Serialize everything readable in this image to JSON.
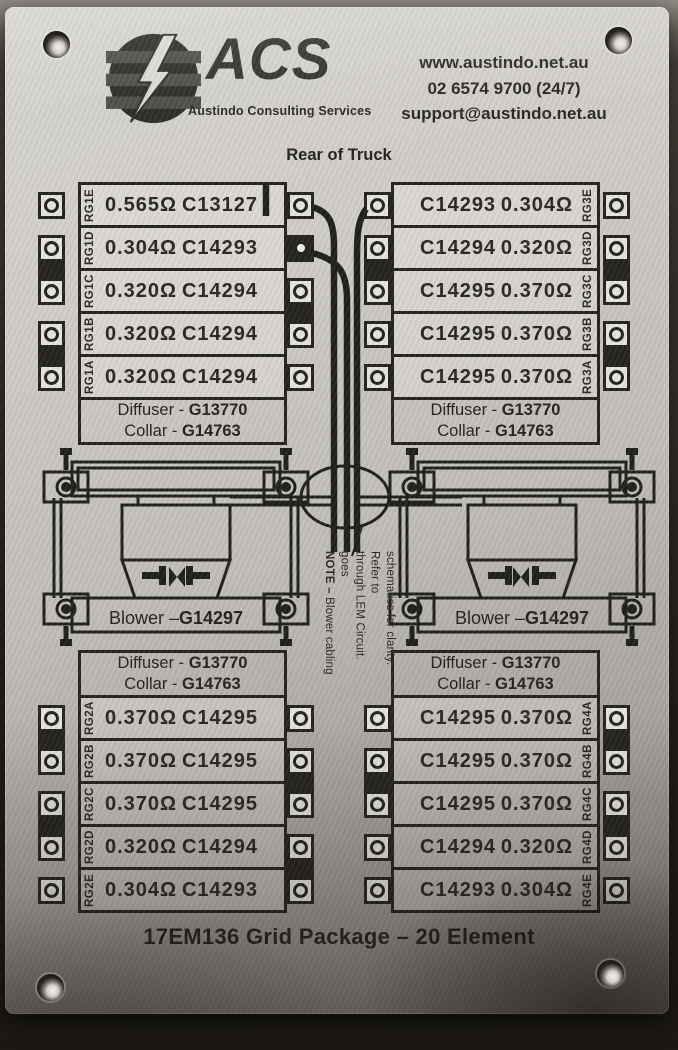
{
  "plate": {
    "header": {
      "logo_acronym": "ACS",
      "logo_tagline": "Austindo Consulting Services",
      "contact": {
        "website": "www.austindo.net.au",
        "phone": "02 6574 9700 (24/7)",
        "email": "support@austindo.net.au"
      }
    },
    "orientation_label": "Rear of Truck",
    "shared": {
      "diffuser_name": "Diffuser - ",
      "diffuser_code": "G13770",
      "collar_name": "Collar - ",
      "collar_code": "G14763",
      "blower_name": "Blower – ",
      "blower_code": "G14297"
    },
    "grids": {
      "top_left": {
        "rows": [
          {
            "label": "RG1E",
            "resistance": "0.565Ω",
            "part": "C13127"
          },
          {
            "label": "RG1D",
            "resistance": "0.304Ω",
            "part": "C14293"
          },
          {
            "label": "RG1C",
            "resistance": "0.320Ω",
            "part": "C14294"
          },
          {
            "label": "RG1B",
            "resistance": "0.320Ω",
            "part": "C14294"
          },
          {
            "label": "RG1A",
            "resistance": "0.320Ω",
            "part": "C14294"
          }
        ]
      },
      "top_right": {
        "rows": [
          {
            "label": "RG3E",
            "part": "C14293",
            "resistance": "0.304Ω"
          },
          {
            "label": "RG3D",
            "part": "C14294",
            "resistance": "0.320Ω"
          },
          {
            "label": "RG3C",
            "part": "C14295",
            "resistance": "0.370Ω"
          },
          {
            "label": "RG3B",
            "part": "C14295",
            "resistance": "0.370Ω"
          },
          {
            "label": "RG3A",
            "part": "C14295",
            "resistance": "0.370Ω"
          }
        ]
      },
      "bottom_left": {
        "rows": [
          {
            "label": "RG2A",
            "resistance": "0.370Ω",
            "part": "C14295"
          },
          {
            "label": "RG2B",
            "resistance": "0.370Ω",
            "part": "C14295"
          },
          {
            "label": "RG2C",
            "resistance": "0.370Ω",
            "part": "C14295"
          },
          {
            "label": "RG2D",
            "resistance": "0.320Ω",
            "part": "C14294"
          },
          {
            "label": "RG2E",
            "resistance": "0.304Ω",
            "part": "C14293"
          }
        ]
      },
      "bottom_right": {
        "rows": [
          {
            "label": "RG4A",
            "part": "C14295",
            "resistance": "0.370Ω"
          },
          {
            "label": "RG4B",
            "part": "C14295",
            "resistance": "0.370Ω"
          },
          {
            "label": "RG4C",
            "part": "C14295",
            "resistance": "0.370Ω"
          },
          {
            "label": "RG4D",
            "part": "C14294",
            "resistance": "0.320Ω"
          },
          {
            "label": "RG4E",
            "part": "C14293",
            "resistance": "0.304Ω"
          }
        ]
      }
    },
    "note": {
      "bold": "NOTE – ",
      "line1": "Blower cabling goes",
      "line2": "through LEM Circuit. Refer to",
      "line3": "schematics for clarity."
    },
    "footer_title": "17EM136 Grid Package – 20 Element"
  }
}
